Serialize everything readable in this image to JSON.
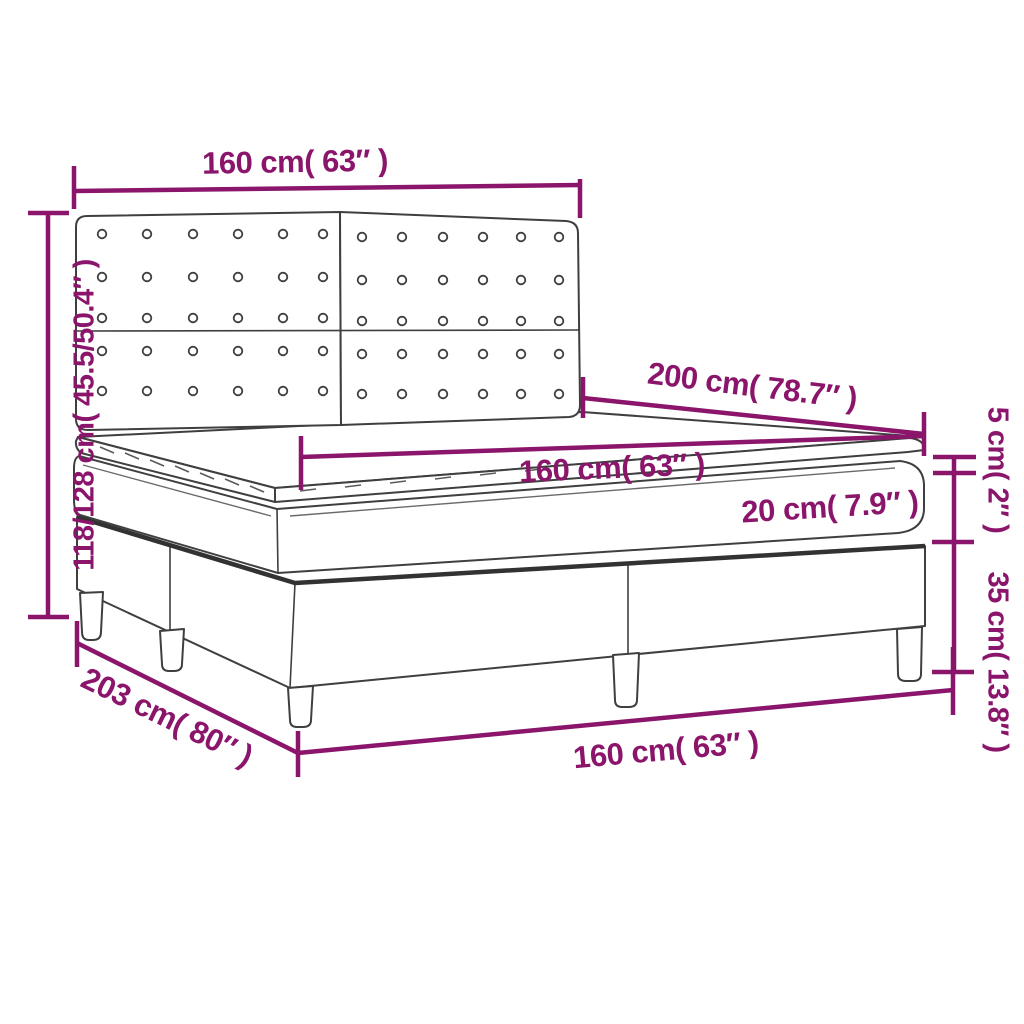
{
  "diagram": {
    "type": "furniture-dimension-diagram",
    "subject": "Box spring bed with tufted headboard, pocket mattress and topper",
    "colors": {
      "accent": "#8A156B",
      "outline": "#3F3F3F",
      "background": "#FFFFFF"
    },
    "dimensions": {
      "headboard_width": {
        "label": "160 cm( 63″ )"
      },
      "overall_height": {
        "label": "118/128 cm( 45.5/50.4″ )"
      },
      "mattress_length": {
        "label": "200 cm( 78.7″ )"
      },
      "mattress_width": {
        "label": "160 cm( 63″ )"
      },
      "mattress_thickness": {
        "label": "20 cm( 7.9″ )"
      },
      "topper_thickness": {
        "label": "5 cm( 2″ )"
      },
      "base_height": {
        "label": "35 cm( 13.8″ )"
      },
      "overall_length": {
        "label": "203 cm( 80″ )"
      },
      "base_width": {
        "label": "160 cm( 63″ )"
      }
    },
    "headboard": {
      "left_panel_columns": [
        102,
        147,
        193,
        238,
        283,
        323
      ],
      "right_panel_columns": [
        362,
        402,
        443,
        483,
        521,
        559
      ],
      "rows_upper": [
        234,
        277,
        318
      ],
      "rows_lower": [
        351,
        391
      ]
    }
  }
}
